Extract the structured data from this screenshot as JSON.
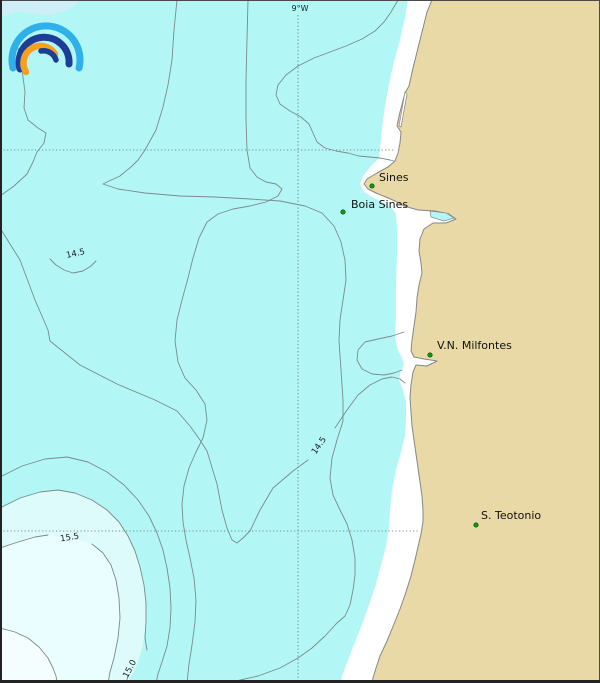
{
  "map": {
    "grid": {
      "meridian_label": "9°W"
    },
    "places": [
      {
        "name": "Sines"
      },
      {
        "name": "Boia Sines"
      },
      {
        "name": "V.N. Milfontes"
      },
      {
        "name": "S. Teotonio"
      }
    ],
    "contour_labels": [
      {
        "value": "14.5"
      },
      {
        "value": "14.5"
      },
      {
        "value": "15.5"
      },
      {
        "value": "15.0"
      }
    ],
    "icons": [
      {
        "name": "rainbow-arcs-logo"
      }
    ],
    "colors": {
      "sea": "#b2f7f5",
      "sea_patch_nw": "#cfeff8",
      "sea_light": "#ddfbfa",
      "sea_lighter": "#eafeff",
      "sea_lightest": "#f4feff",
      "land": "#e9d9a6",
      "coast_strip": "#ffffff",
      "contour_line": "#7b8a8a",
      "marker_green": "#0f9b0f",
      "logo_light_blue": "#2fb0e8",
      "logo_dark_blue": "#1c3e96",
      "logo_orange": "#f7a01f"
    }
  }
}
